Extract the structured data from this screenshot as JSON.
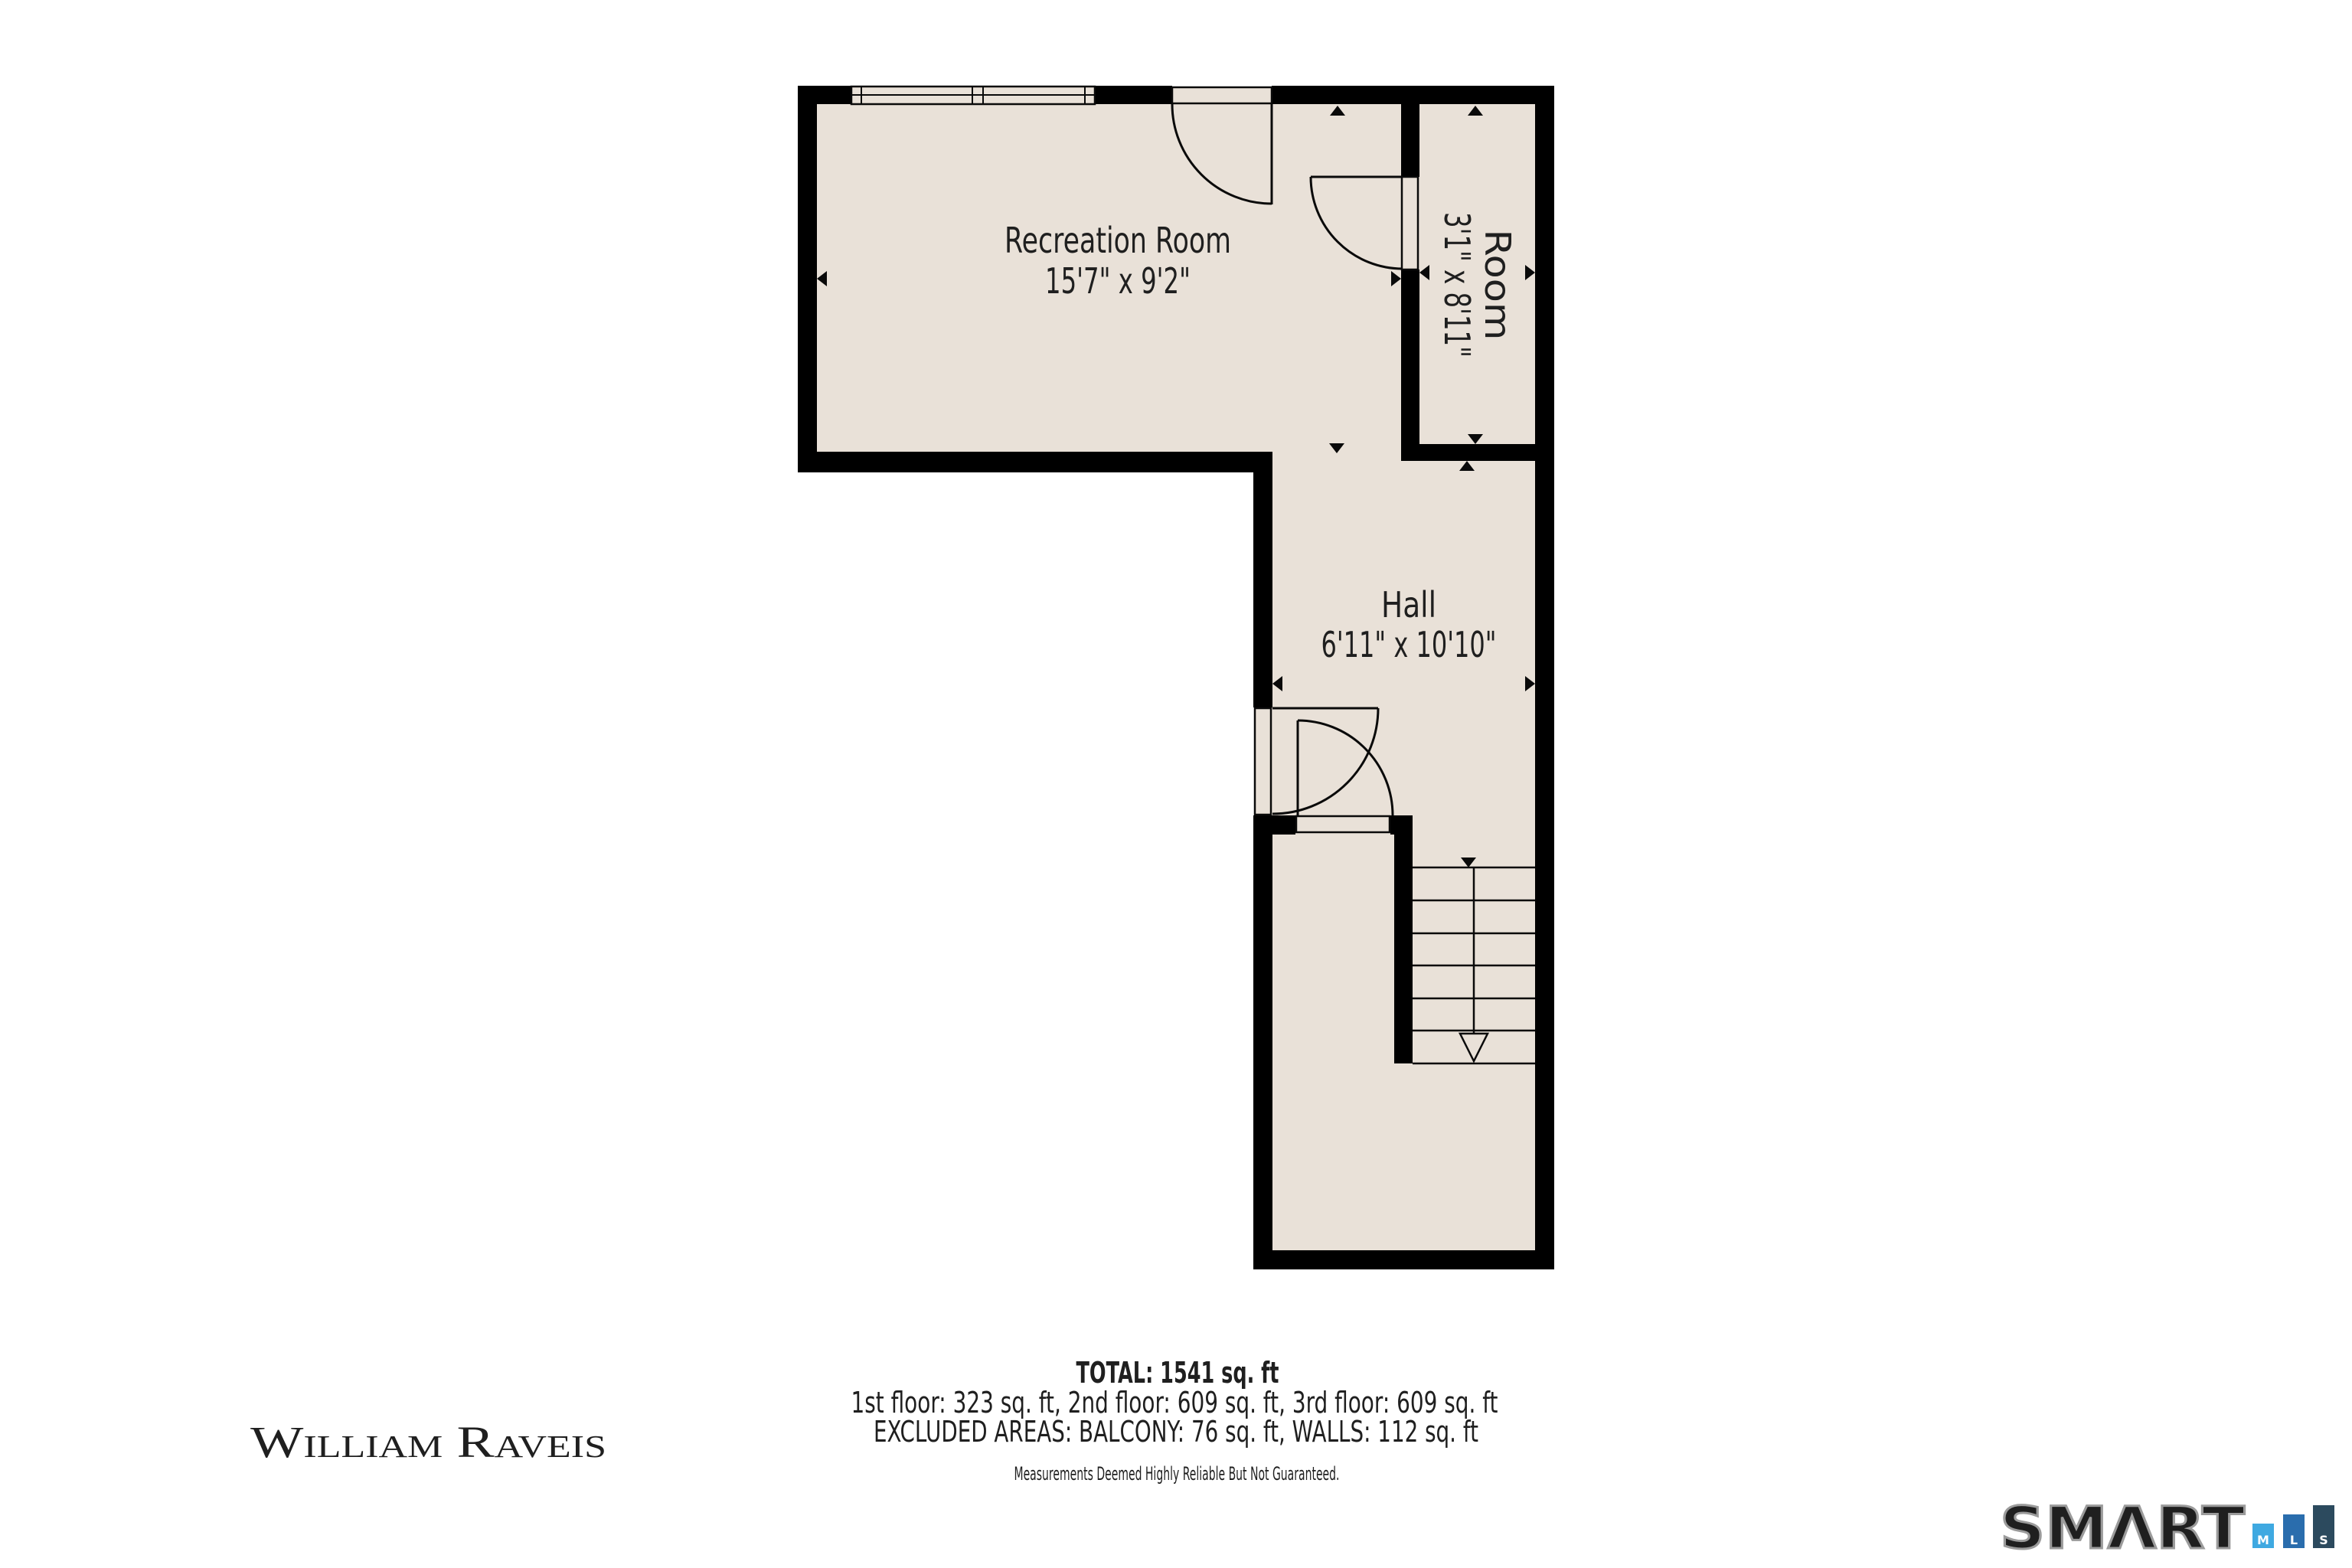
{
  "page": {
    "background": "#ffffff"
  },
  "plan": {
    "floor_color": "#e9e1d8",
    "wall_color": "#000000",
    "line_color": "#0a0a0a",
    "rooms": [
      {
        "name": "Recreation Room",
        "dimensions": "15'7\" x 9'2\""
      },
      {
        "name": "Room",
        "dimensions": "3'1\" x 8'11\""
      },
      {
        "name": "Hall",
        "dimensions": "6'11\" x 10'10\""
      }
    ]
  },
  "summary": {
    "total": "TOTAL: 1541 sq. ft",
    "floors": "1st floor: 323 sq. ft, 2nd floor: 609 sq. ft, 3rd floor: 609 sq. ft",
    "excluded": "EXCLUDED AREAS: BALCONY: 76 sq. ft, WALLS: 112 sq. ft",
    "disclaimer": "Measurements Deemed Highly Reliable But Not Guaranteed.",
    "disclaimer_color": "#6f8fb8"
  },
  "branding": {
    "agency": {
      "name": "William Raveis",
      "color": "#5d87b7"
    },
    "mls": {
      "wordmark": "SMΛRT",
      "outline_color": "#9b9b9b",
      "bars": [
        {
          "label": "M",
          "color": "#3fa9e1"
        },
        {
          "label": "L",
          "color": "#2a6dad"
        },
        {
          "label": "S",
          "color": "#2c4a5e"
        }
      ]
    }
  }
}
